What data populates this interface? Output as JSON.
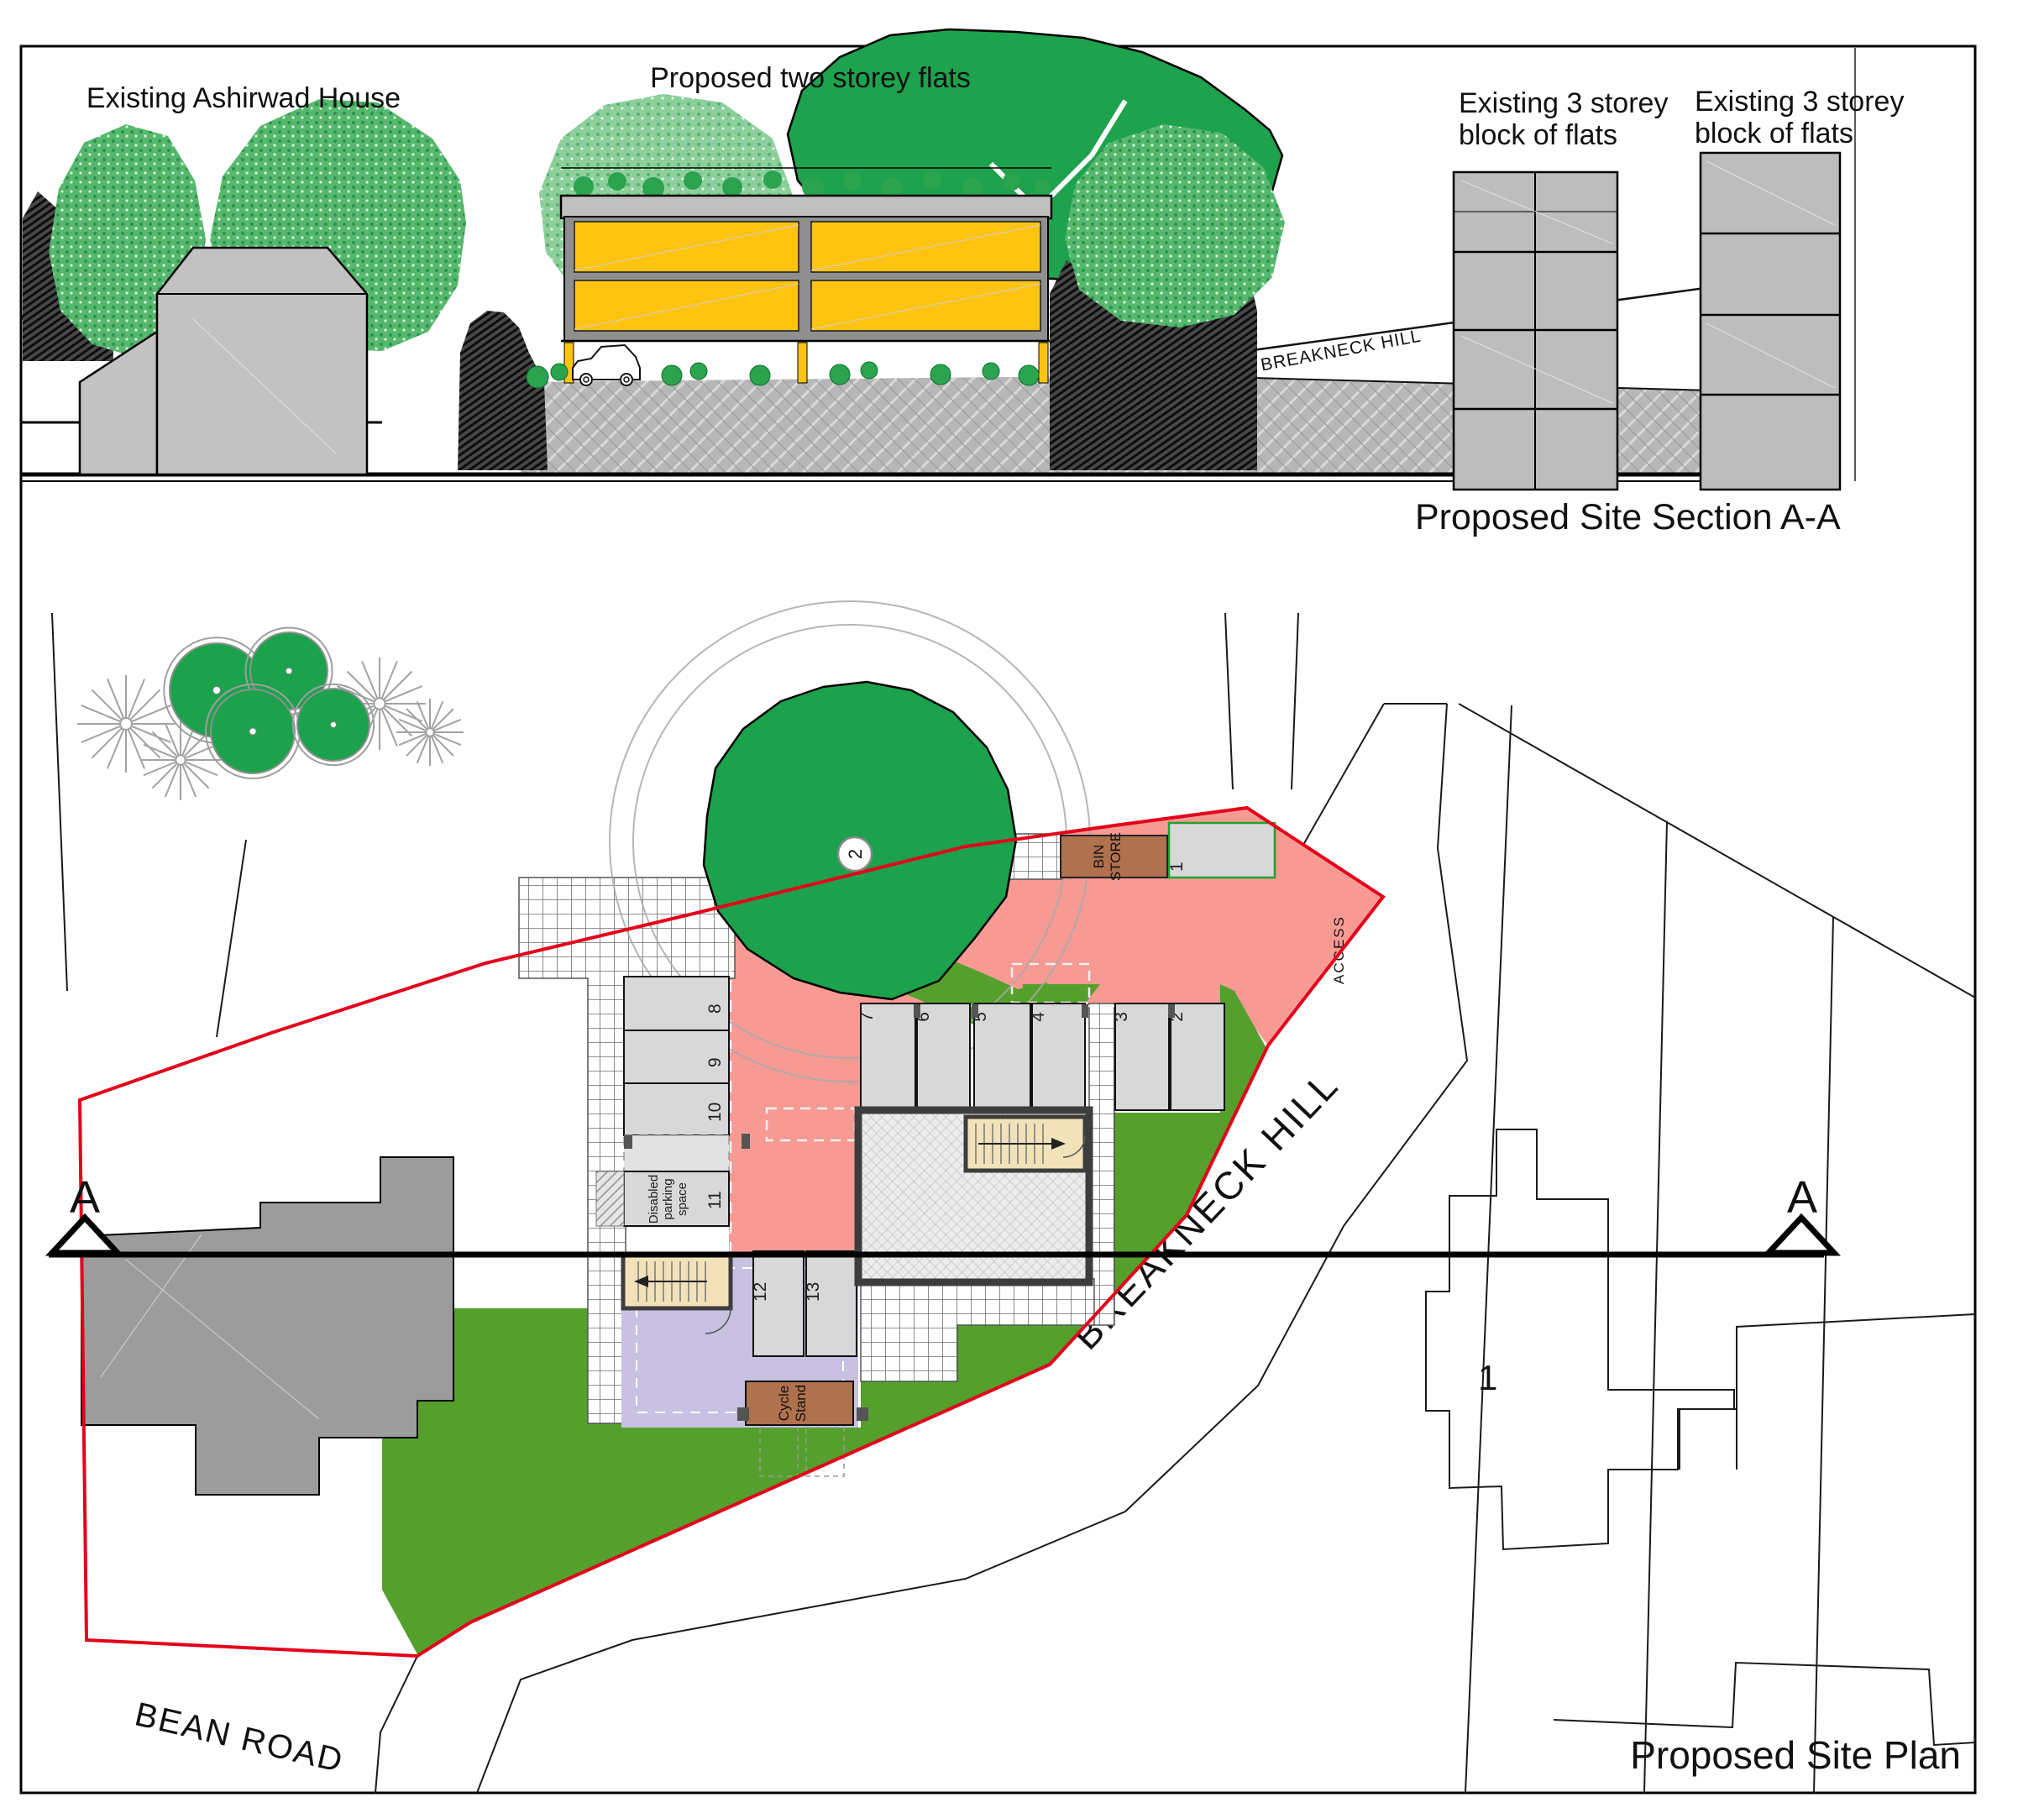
{
  "titles": {
    "section": "Proposed Site Section A-A",
    "plan": "Proposed Site Plan"
  },
  "section": {
    "labels": {
      "existing_house": "Existing Ashirwad House",
      "proposed_flats": "Proposed two storey flats",
      "existing_flats_line1": "Existing 3 storey",
      "existing_flats_line2": "block of flats",
      "road": "BREAKNECK HILL"
    }
  },
  "plan": {
    "roads": {
      "bean_road": "BEAN ROAD",
      "breakneck_hill": "BREAKNECK HILL"
    },
    "markers": {
      "left": "A",
      "right": "A"
    },
    "parking_numbers": [
      "1",
      "2",
      "3",
      "4",
      "5",
      "6",
      "7",
      "8",
      "9",
      "10",
      "11",
      "12",
      "13"
    ],
    "bin_store": {
      "line1": "BIN",
      "line2": "STORE"
    },
    "cycle_stand": {
      "line1": "Cycle",
      "line2": "Stand"
    },
    "disabled": {
      "line1": "Disabled",
      "line2": "parking",
      "line3": "space"
    },
    "access": "ACCESS",
    "tree_label": "2",
    "house_label": "1"
  },
  "colors": {
    "boundary_red": "#e3001b",
    "access_pink": "#f79a94",
    "lawn_green": "#55a02c",
    "tree_green": "#1ca24c",
    "flats_yellow": "#ffc40f",
    "amenity_purple": "#c8c1e2",
    "store_brown": "#b0714e",
    "stair_beige": "#f2e2ba"
  }
}
